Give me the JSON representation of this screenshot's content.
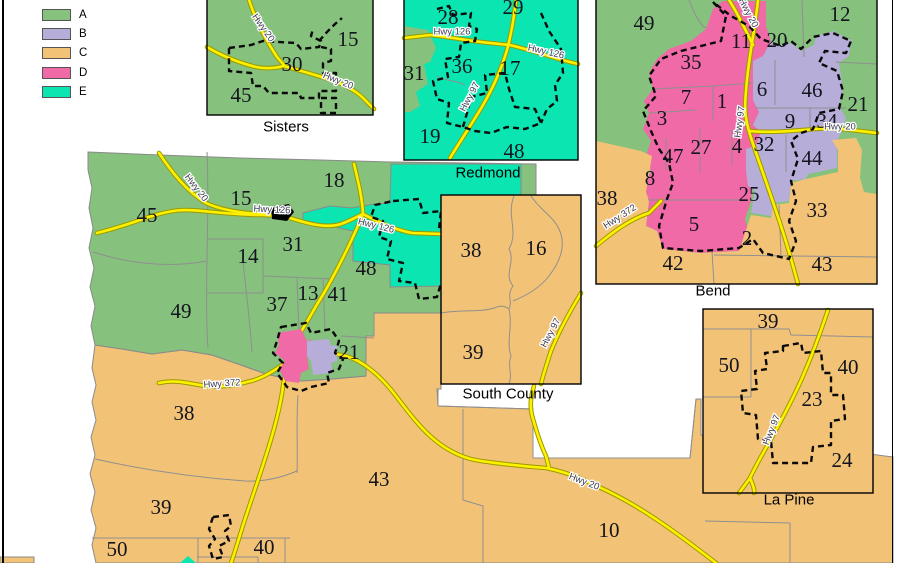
{
  "legend": {
    "items": [
      {
        "label": "A",
        "color": "#86C17D"
      },
      {
        "label": "B",
        "color": "#B6ADD8"
      },
      {
        "label": "C",
        "color": "#F2C377"
      },
      {
        "label": "D",
        "color": "#EF6AA6"
      },
      {
        "label": "E",
        "color": "#0AE5B1"
      }
    ]
  },
  "colors": {
    "road_fill": "#FFF000",
    "road_casing": "#9A9A00",
    "boundary_gray": "#8F8F8F",
    "city_dash_black": "#0A0A0A",
    "background": "#FFFFFF"
  },
  "insets": {
    "sisters": {
      "caption": "Sisters"
    },
    "redmond": {
      "caption": "Redmond"
    },
    "bend": {
      "caption": "Bend"
    },
    "south": {
      "caption": "South County"
    },
    "lapine": {
      "caption": "La Pine"
    }
  },
  "labels": {
    "captions": [
      {
        "t": "Sisters",
        "x": 286,
        "y": 127
      },
      {
        "t": "Redmond",
        "x": 488,
        "y": 173
      },
      {
        "t": "Bend",
        "x": 713,
        "y": 291
      },
      {
        "t": "South County",
        "x": 508,
        "y": 394
      },
      {
        "t": "La Pine",
        "x": 789,
        "y": 500
      }
    ],
    "main_numbers": [
      {
        "t": "45",
        "x": 147,
        "y": 215
      },
      {
        "t": "15",
        "x": 241,
        "y": 198
      },
      {
        "t": "18",
        "x": 334,
        "y": 180
      },
      {
        "t": "14",
        "x": 248,
        "y": 256
      },
      {
        "t": "31",
        "x": 293,
        "y": 244
      },
      {
        "t": "48",
        "x": 366,
        "y": 268
      },
      {
        "t": "49",
        "x": 181,
        "y": 311
      },
      {
        "t": "37",
        "x": 277,
        "y": 304
      },
      {
        "t": "13",
        "x": 308,
        "y": 293
      },
      {
        "t": "41",
        "x": 338,
        "y": 294
      },
      {
        "t": "21",
        "x": 349,
        "y": 352
      },
      {
        "t": "38",
        "x": 184,
        "y": 413
      },
      {
        "t": "39",
        "x": 161,
        "y": 507
      },
      {
        "t": "50",
        "x": 117,
        "y": 549
      },
      {
        "t": "40",
        "x": 264,
        "y": 547
      },
      {
        "t": "43",
        "x": 379,
        "y": 479
      },
      {
        "t": "10",
        "x": 609,
        "y": 530
      }
    ],
    "sisters_numbers": [
      {
        "t": "15",
        "x": 348,
        "y": 39
      },
      {
        "t": "30",
        "x": 292,
        "y": 64
      },
      {
        "t": "45",
        "x": 241,
        "y": 95
      }
    ],
    "redmond_numbers": [
      {
        "t": "28",
        "x": 448,
        "y": 17
      },
      {
        "t": "29",
        "x": 513,
        "y": 7
      },
      {
        "t": "31",
        "x": 414,
        "y": 73
      },
      {
        "t": "36",
        "x": 462,
        "y": 66
      },
      {
        "t": "17",
        "x": 510,
        "y": 68
      },
      {
        "t": "19",
        "x": 430,
        "y": 136
      },
      {
        "t": "48",
        "x": 514,
        "y": 151
      }
    ],
    "bend_numbers": [
      {
        "t": "49",
        "x": 644,
        "y": 23
      },
      {
        "t": "35",
        "x": 691,
        "y": 62
      },
      {
        "t": "11",
        "x": 741,
        "y": 41
      },
      {
        "t": "20",
        "x": 777,
        "y": 40
      },
      {
        "t": "12",
        "x": 840,
        "y": 14
      },
      {
        "t": "7",
        "x": 686,
        "y": 97
      },
      {
        "t": "1",
        "x": 722,
        "y": 101
      },
      {
        "t": "6",
        "x": 762,
        "y": 89
      },
      {
        "t": "46",
        "x": 812,
        "y": 90
      },
      {
        "t": "21",
        "x": 858,
        "y": 104
      },
      {
        "t": "3",
        "x": 662,
        "y": 118
      },
      {
        "t": "9",
        "x": 790,
        "y": 121
      },
      {
        "t": "34",
        "x": 827,
        "y": 121
      },
      {
        "t": "47",
        "x": 673,
        "y": 156
      },
      {
        "t": "27",
        "x": 701,
        "y": 147
      },
      {
        "t": "4",
        "x": 737,
        "y": 146
      },
      {
        "t": "32",
        "x": 764,
        "y": 144
      },
      {
        "t": "44",
        "x": 812,
        "y": 158
      },
      {
        "t": "8",
        "x": 650,
        "y": 178
      },
      {
        "t": "25",
        "x": 749,
        "y": 194
      },
      {
        "t": "38",
        "x": 607,
        "y": 198
      },
      {
        "t": "33",
        "x": 817,
        "y": 210
      },
      {
        "t": "5",
        "x": 694,
        "y": 224
      },
      {
        "t": "2",
        "x": 747,
        "y": 238
      },
      {
        "t": "42",
        "x": 673,
        "y": 263
      },
      {
        "t": "43",
        "x": 822,
        "y": 264
      }
    ],
    "south_numbers": [
      {
        "t": "38",
        "x": 471,
        "y": 250
      },
      {
        "t": "16",
        "x": 536,
        "y": 248
      },
      {
        "t": "39",
        "x": 473,
        "y": 352
      }
    ],
    "lapine_numbers": [
      {
        "t": "39",
        "x": 768,
        "y": 321
      },
      {
        "t": "50",
        "x": 729,
        "y": 365
      },
      {
        "t": "40",
        "x": 848,
        "y": 367
      },
      {
        "t": "23",
        "x": 812,
        "y": 399
      },
      {
        "t": "24",
        "x": 842,
        "y": 460
      }
    ],
    "roads": [
      {
        "t": "Hwy 20",
        "x": 196,
        "y": 188,
        "r": 52
      },
      {
        "t": "Hwy 126",
        "x": 272,
        "y": 210,
        "r": 3
      },
      {
        "t": "Hwy 126",
        "x": 376,
        "y": 226,
        "r": 14
      },
      {
        "t": "Hwy 372",
        "x": 222,
        "y": 384,
        "r": -4
      },
      {
        "t": "Hwy 20",
        "x": 584,
        "y": 482,
        "r": 21
      },
      {
        "t": "Hwy 20",
        "x": 263,
        "y": 28,
        "r": 55
      },
      {
        "t": "Hwy 20",
        "x": 338,
        "y": 81,
        "r": 22
      },
      {
        "t": "Hwy 126",
        "x": 452,
        "y": 32,
        "r": 0
      },
      {
        "t": "Hwy 126",
        "x": 546,
        "y": 52,
        "r": 13
      },
      {
        "t": "Hwy 97",
        "x": 470,
        "y": 97,
        "r": -62
      },
      {
        "t": "Hwy 20",
        "x": 748,
        "y": 13,
        "r": 62
      },
      {
        "t": "Hwy 97",
        "x": 740,
        "y": 122,
        "r": -82
      },
      {
        "t": "Hwy 20",
        "x": 840,
        "y": 127,
        "r": 0
      },
      {
        "t": "Hwy 372",
        "x": 620,
        "y": 217,
        "r": -33
      },
      {
        "t": "Hwy 97",
        "x": 551,
        "y": 333,
        "r": -62
      },
      {
        "t": "Hwy 97",
        "x": 772,
        "y": 430,
        "r": -68
      }
    ]
  }
}
